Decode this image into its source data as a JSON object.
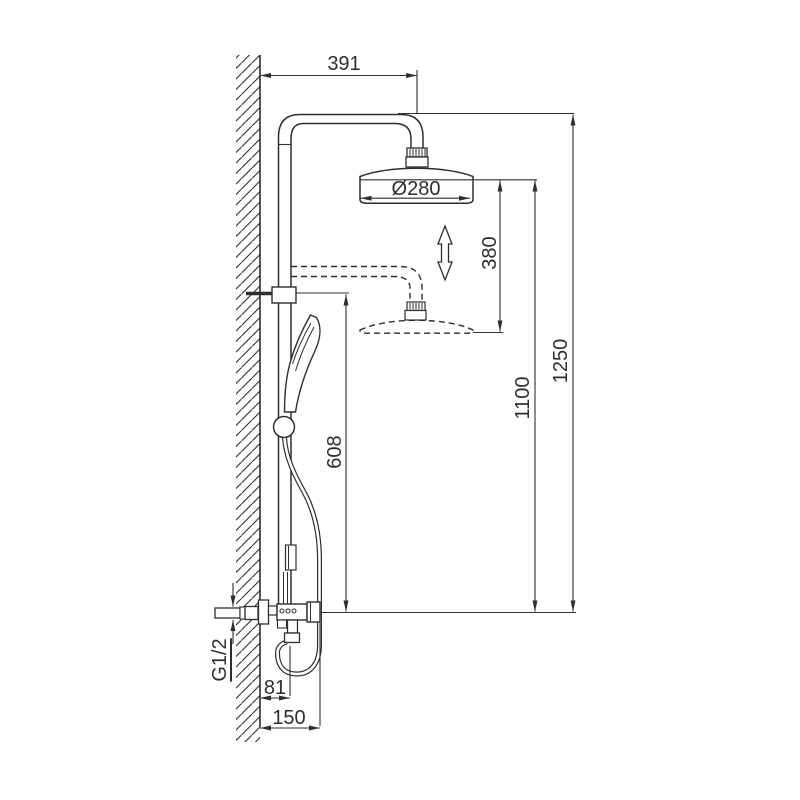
{
  "drawing": {
    "kind": "shower-column-installation-diagram",
    "colors": {
      "line": "#2e2e2e",
      "background": "#ffffff"
    },
    "dimensions": {
      "reach": "391",
      "head_diameter": "Ø280",
      "height_adjustment": "380",
      "head_height": "1100",
      "total_height": "1250",
      "rail_height": "608",
      "inlet_thread": "G1/2",
      "hose_offset": "81",
      "valve_depth": "150"
    }
  }
}
